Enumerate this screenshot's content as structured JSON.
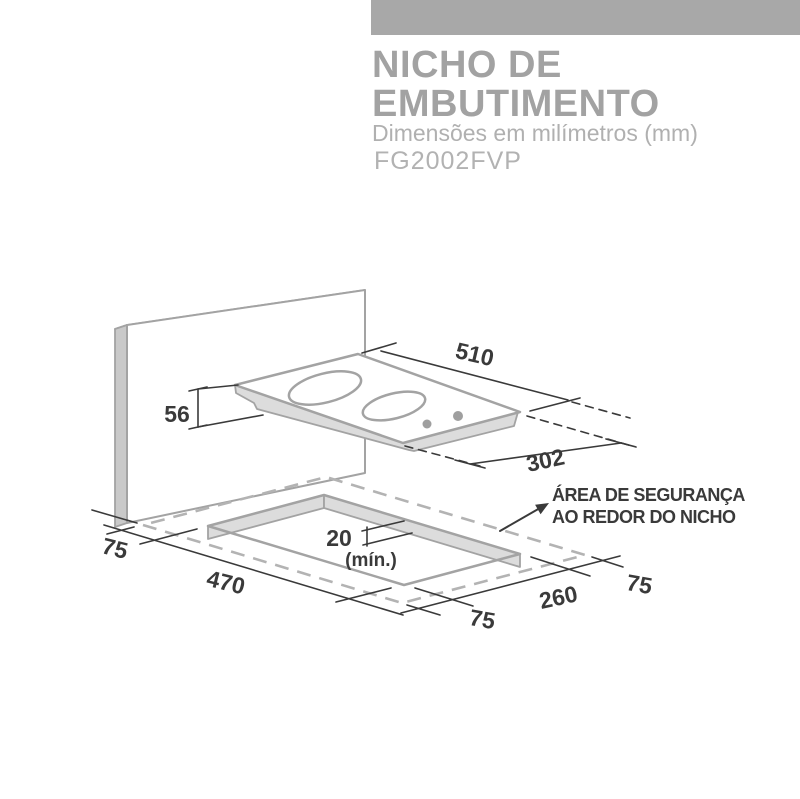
{
  "header": {
    "title_line1": "NICHO DE",
    "title_line2": "EMBUTIMENTO",
    "subtitle": "Dimensões em milímetros (mm)",
    "model": "FG2002FVP",
    "bar_color": "#a8a8a8"
  },
  "diagram": {
    "unit": "mm",
    "cooktop": {
      "width": "510",
      "depth": "302",
      "height": "56"
    },
    "niche": {
      "width": "470",
      "depth": "260",
      "thickness_min": "20",
      "thickness_note": "(mín.)"
    },
    "margins": {
      "left": "75",
      "front": "75",
      "right": "75"
    },
    "safety_note": {
      "line1": "ÁREA DE SEGURANÇA",
      "line2": "AO REDOR DO NICHO"
    },
    "colors": {
      "outline_gray": "#a3a3a3",
      "shade_light": "#dcdcdc",
      "shade_mid": "#c9c9c9",
      "ink": "#3a3a3a",
      "dash_gray": "#b3b3b3"
    }
  }
}
